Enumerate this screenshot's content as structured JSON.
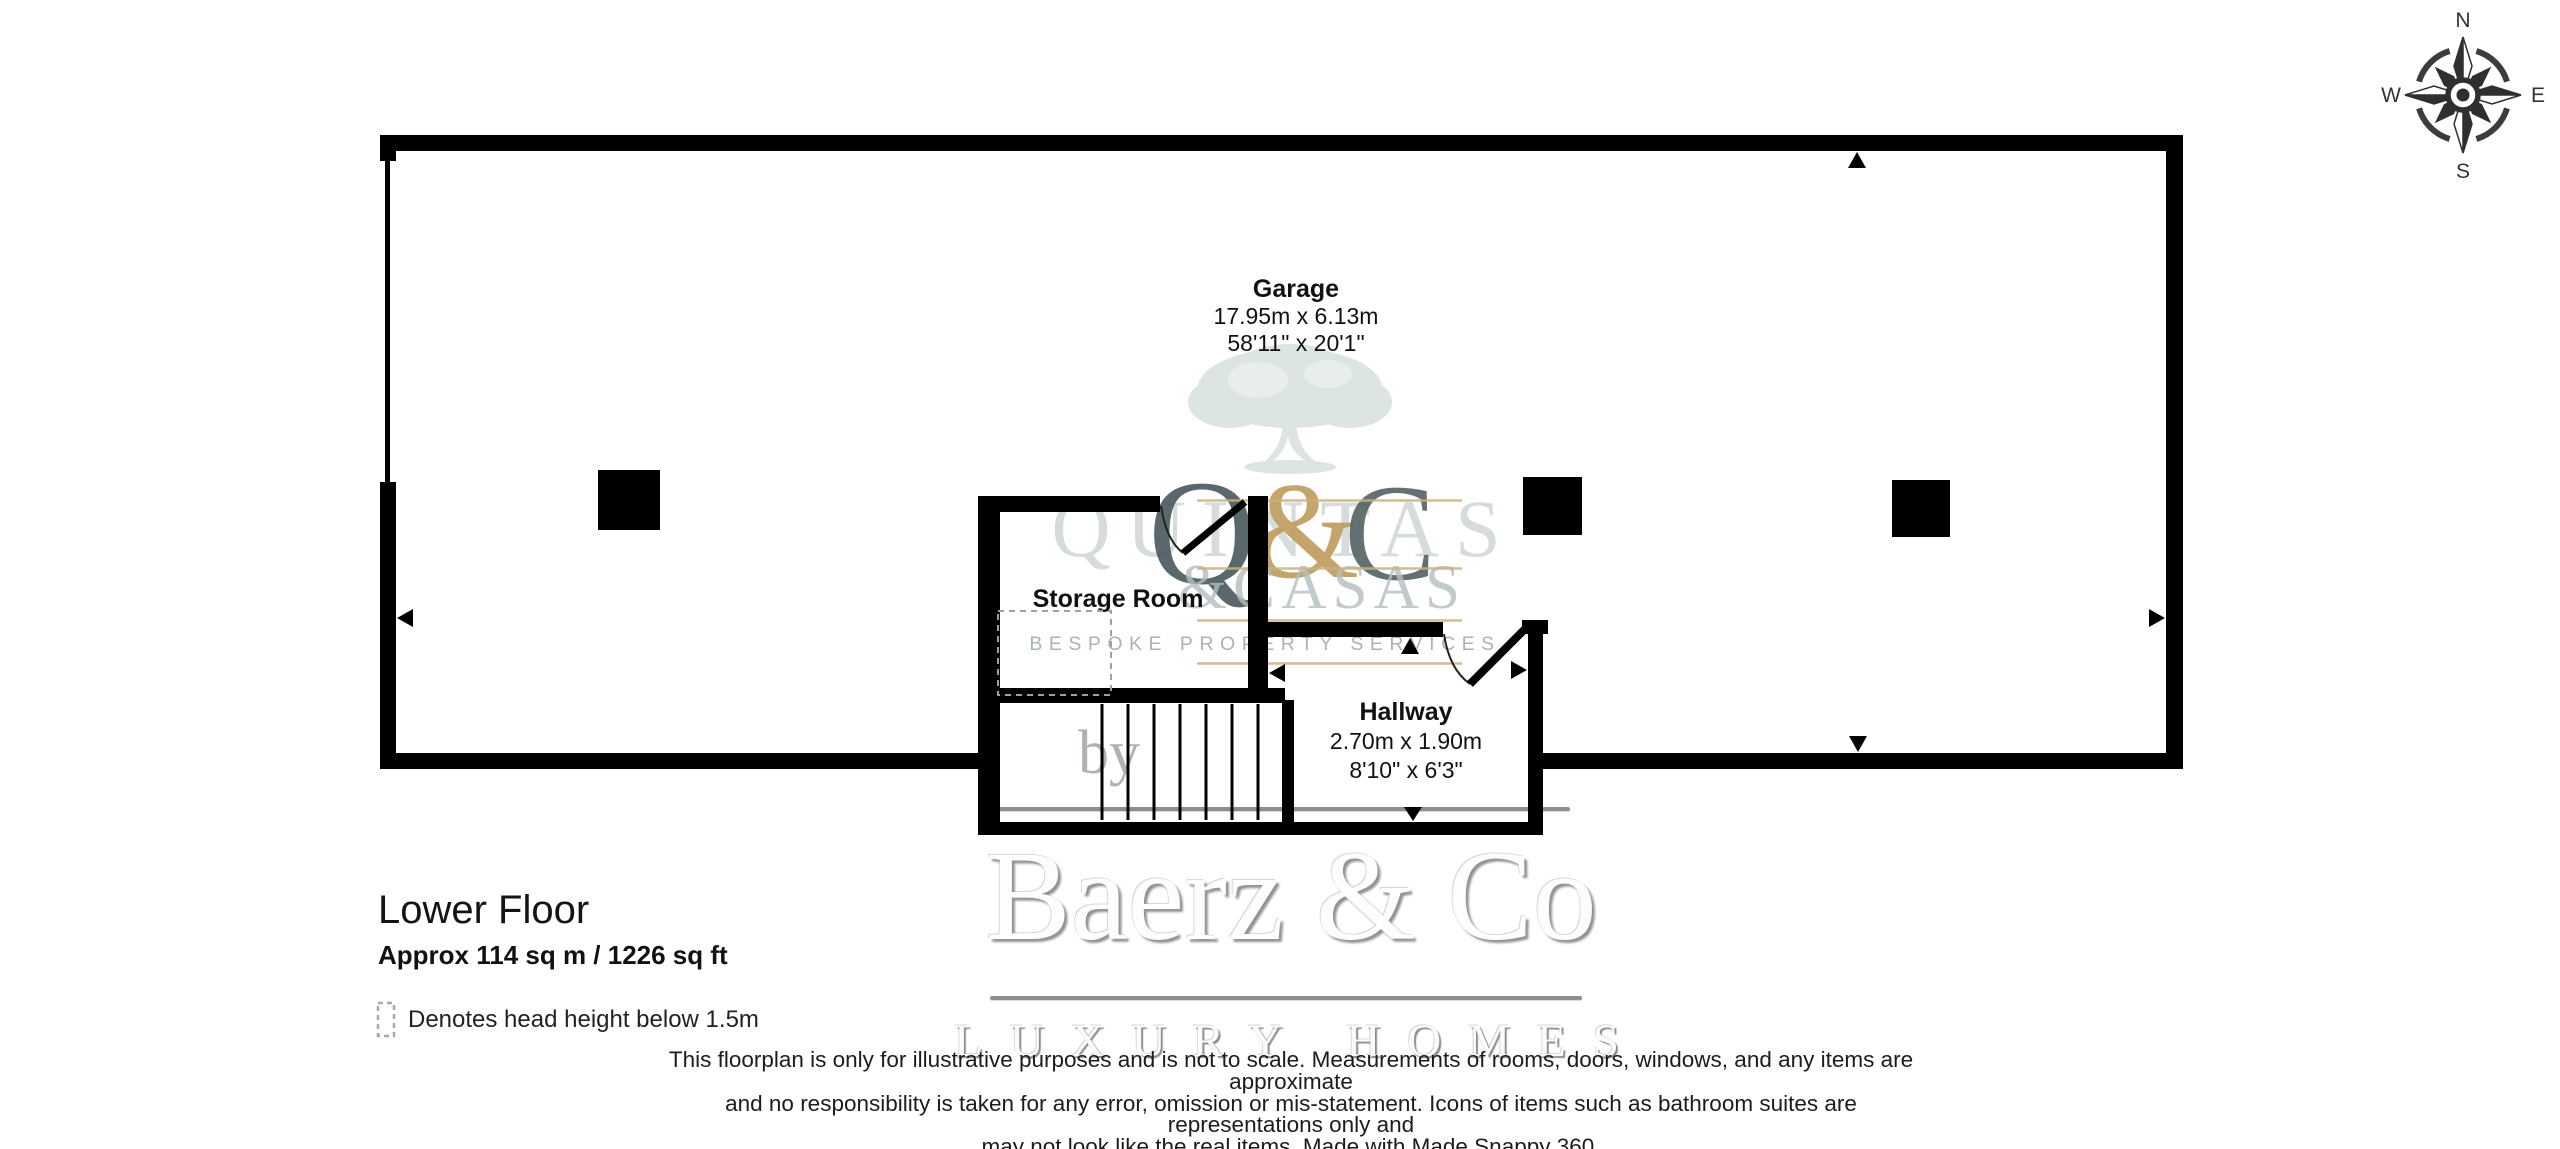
{
  "compass": {
    "n": "N",
    "e": "E",
    "s": "S",
    "w": "W"
  },
  "rooms": {
    "garage": {
      "name": "Garage",
      "metric": "17.95m x 6.13m",
      "imperial": "58'11\" x 20'1\""
    },
    "storage": {
      "name": "Storage Room"
    },
    "hallway": {
      "name": "Hallway",
      "metric": "2.70m x 1.90m",
      "imperial": "8'10\" x 6'3\""
    }
  },
  "floor_info": {
    "title": "Lower Floor",
    "area": "Approx 114 sq m / 1226 sq ft"
  },
  "legend": {
    "head_height": "Denotes head height below 1.5m"
  },
  "disclaimer": {
    "line1": "This floorplan is only for illustrative purposes and is not to scale. Measurements of rooms, doors, windows, and any items are approximate",
    "line2": "and no responsibility is taken for any error, omission or mis-statement. Icons of items such as bathroom suites are representations only and",
    "line3": "may not look like the real items. Made with Made Snappy 360."
  },
  "watermarks": {
    "agency": {
      "monogram_left": "Q",
      "ampersand": "&",
      "monogram_right": "C",
      "overlay_name": "QUINTAS",
      "casas_line": "&CASAS",
      "tagline": "BESPOKE PROPERTY SERVICES"
    },
    "broker": {
      "by": "by",
      "brand": "Baerz & Co",
      "subtitle": "LUXURY HOMES"
    }
  },
  "colors": {
    "wall": "#000000",
    "gold_accent": "#c9b183",
    "sage_tree": "#c9d6d1",
    "slate_monogram": "#44545a",
    "light_gray_text": "#b4bec0",
    "tagline_gray": "#a9b5b5",
    "rule_gray": "#8f8f8f"
  }
}
